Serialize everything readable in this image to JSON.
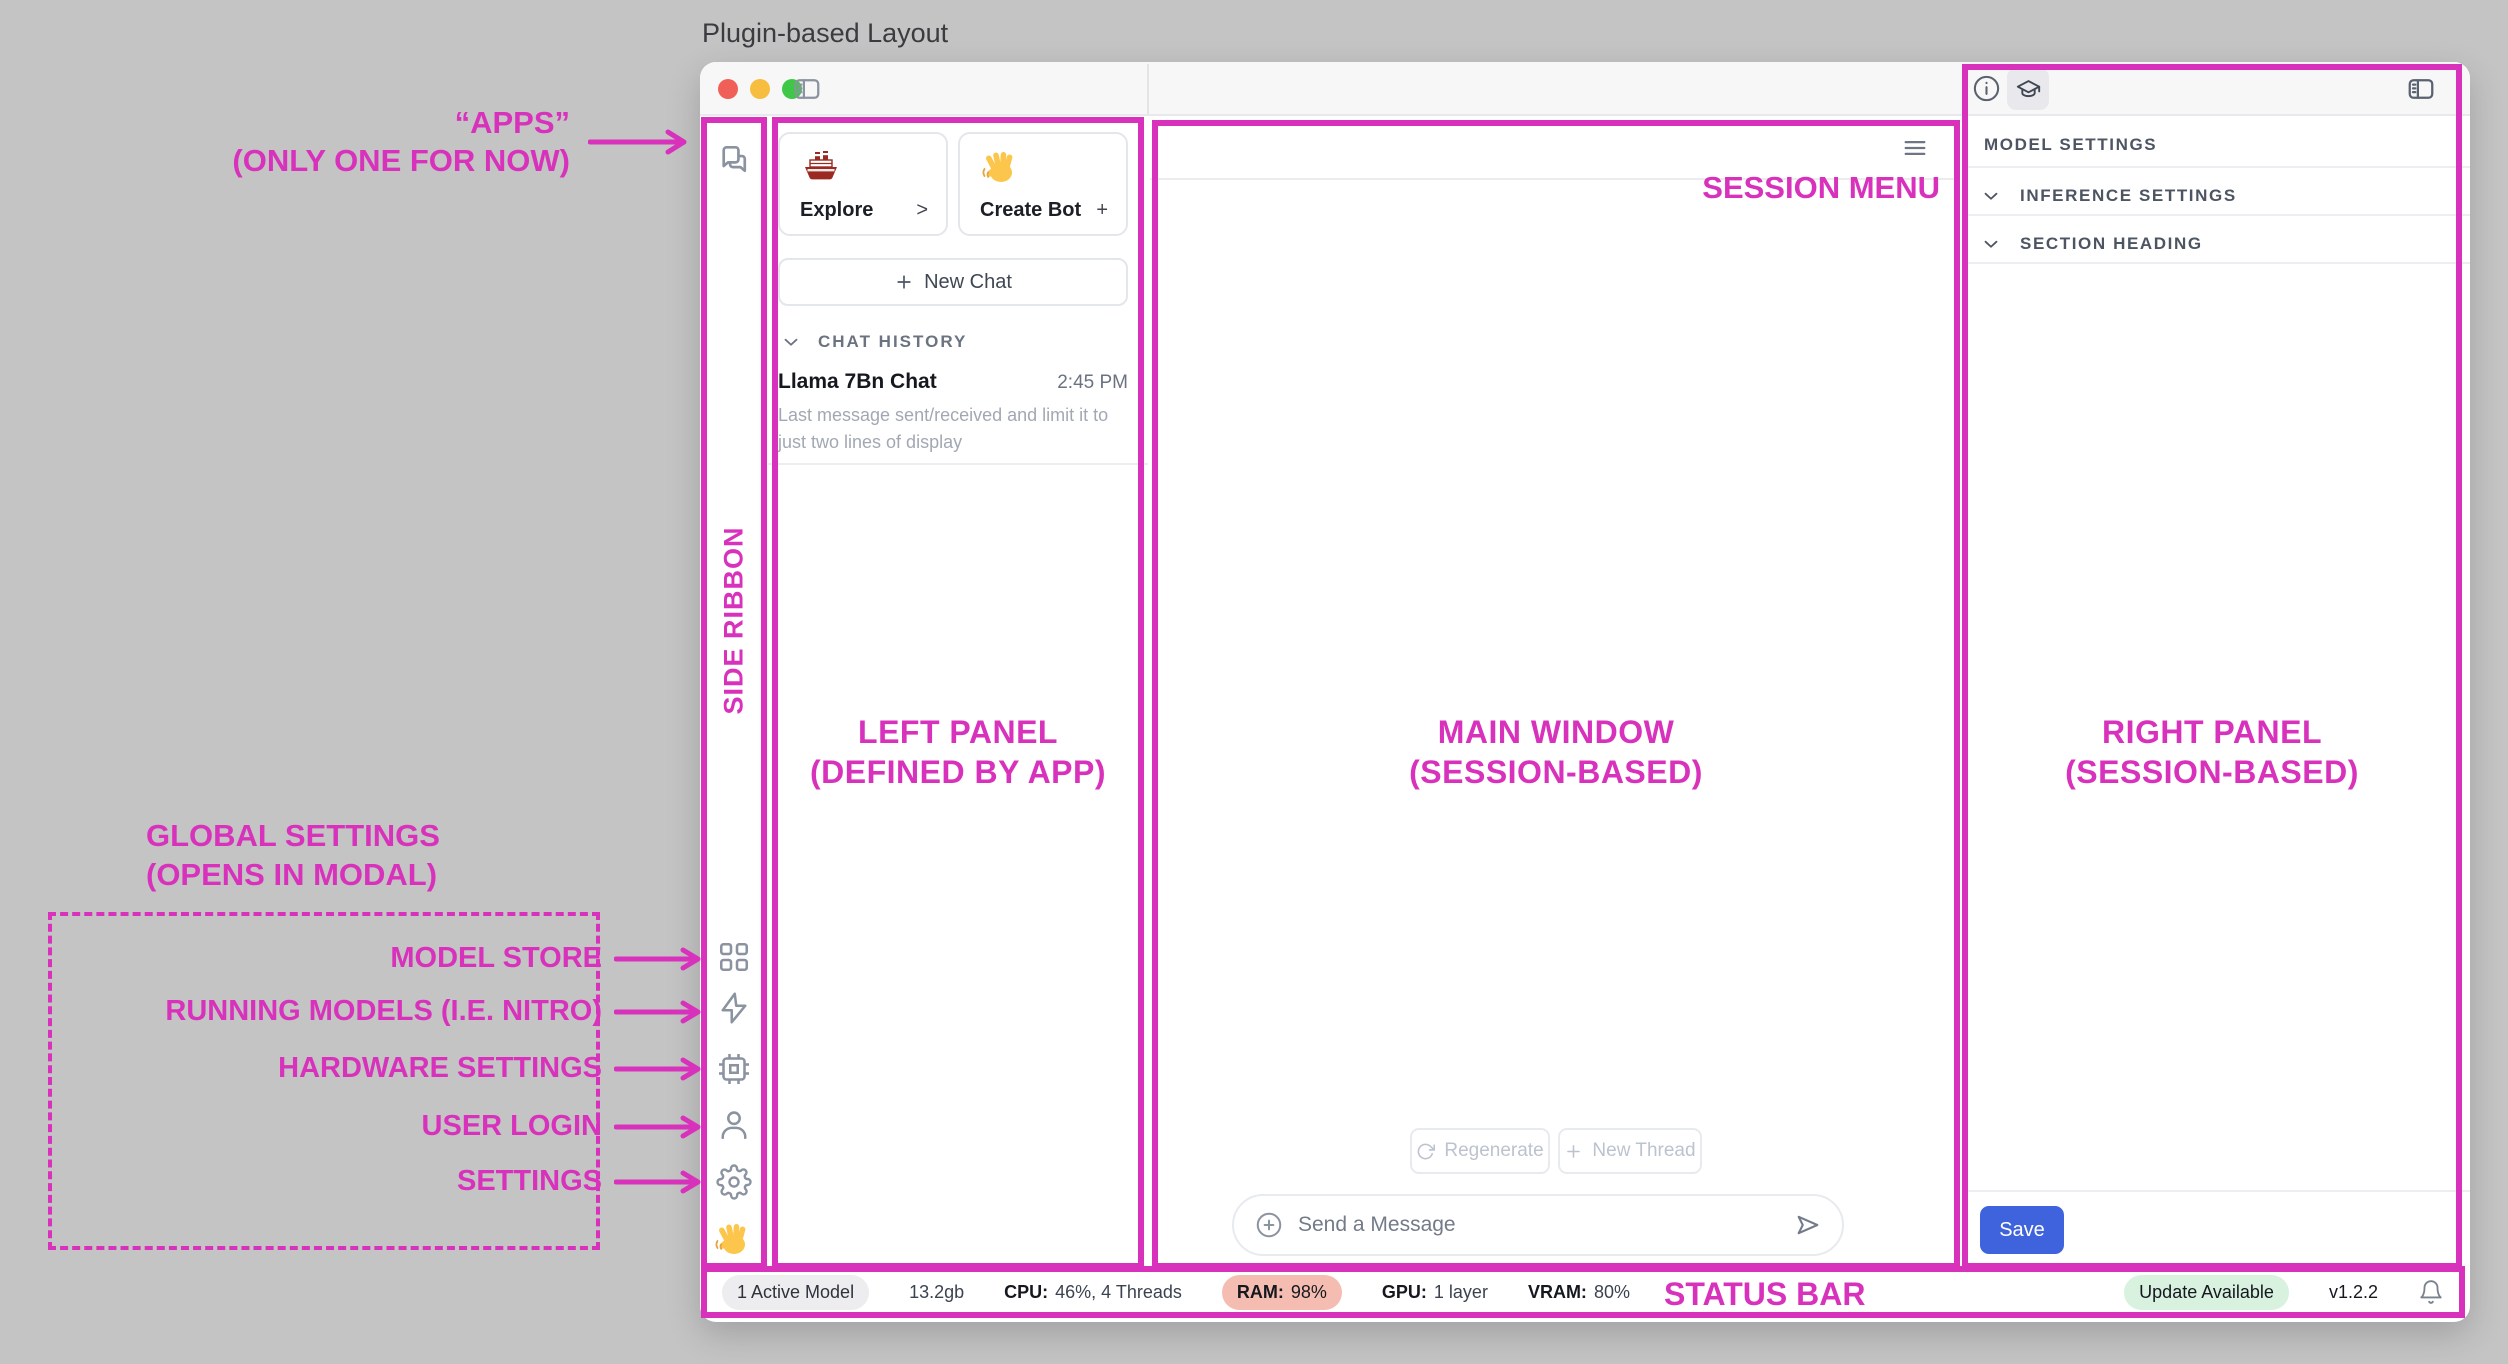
{
  "page": {
    "title": "Plugin-based Layout",
    "background_color": "#c4c4c4",
    "annotation_color": "#d832bc"
  },
  "app": {
    "titlebar": {
      "traffic_light_colors": [
        "#f15f59",
        "#f7bd3e",
        "#3fc748"
      ],
      "icons": [
        "sidebar-toggle"
      ]
    },
    "ribbon": {
      "top_icons": [
        "chat-app"
      ],
      "bottom_icons": [
        "model-store",
        "running-models",
        "hardware-settings",
        "user-login",
        "settings",
        "wave-hand"
      ]
    },
    "left_panel": {
      "cards": [
        {
          "icon": "ship-emoji",
          "label": "Explore",
          "action": ">"
        },
        {
          "icon": "wave-emoji",
          "label": "Create Bot",
          "action": "+"
        }
      ],
      "new_chat_label": "New Chat",
      "history": {
        "header": "CHAT HISTORY",
        "items": [
          {
            "title": "Llama 7Bn Chat",
            "time": "2:45 PM",
            "preview": "Last message sent/received and limit it to just two lines of display"
          }
        ]
      }
    },
    "main": {
      "menu_icon": "hamburger",
      "regenerate_label": "Regenerate",
      "new_thread_label": "New Thread",
      "composer_placeholder": "Send a Message"
    },
    "right_panel": {
      "top_icons": [
        "info",
        "graduation-cap",
        "sidebar-toggle"
      ],
      "header": "MODEL SETTINGS",
      "sections": [
        {
          "label": "INFERENCE SETTINGS"
        },
        {
          "label": "SECTION HEADING"
        }
      ],
      "save_label": "Save",
      "save_color": "#3e63dd"
    },
    "status_bar": {
      "active_models": "1 Active Model",
      "memory": "13.2gb",
      "cpu_label": "CPU:",
      "cpu_value": "46%, 4 Threads",
      "ram_label": "RAM:",
      "ram_value": "98%",
      "ram_pill_color": "#f5bdb2",
      "gpu_label": "GPU:",
      "gpu_value": "1 layer",
      "vram_label": "VRAM:",
      "vram_value": "80%",
      "update_badge": "Update Available",
      "update_badge_color": "#d8f2df",
      "version": "v1.2.2"
    }
  },
  "annotations": {
    "apps": {
      "line1": "“APPS”",
      "line2": "(ONLY ONE FOR NOW)"
    },
    "side_ribbon": "SIDE RIBBON",
    "left_panel": {
      "line1": "LEFT PANEL",
      "line2": "(DEFINED BY APP)"
    },
    "main_window": {
      "line1": "MAIN WINDOW",
      "line2": "(SESSION-BASED)"
    },
    "right_panel": {
      "line1": "RIGHT PANEL",
      "line2": "(SESSION-BASED)"
    },
    "session_menu": "SESSION MENU",
    "status_bar": "STATUS BAR",
    "global_settings": {
      "line1": "GLOBAL SETTINGS",
      "line2": "(OPENS IN MODAL)"
    },
    "ribbon_targets": [
      "MODEL STORE",
      "RUNNING MODELS (I.E. NITRO)",
      "HARDWARE SETTINGS",
      "USER LOGIN",
      "SETTINGS"
    ]
  }
}
